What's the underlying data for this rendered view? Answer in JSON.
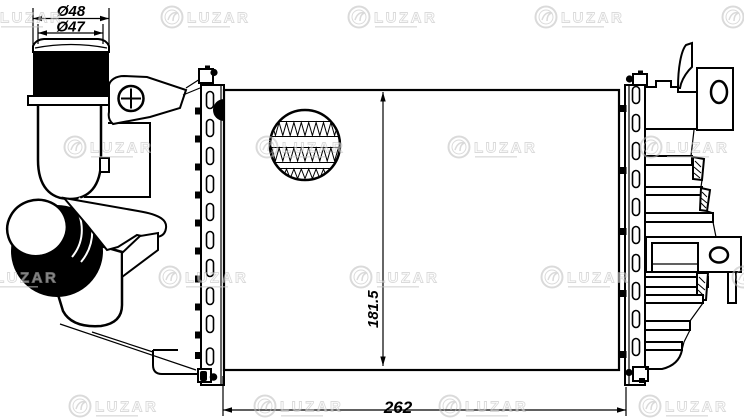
{
  "drawing": {
    "kind": "technical-part-drawing",
    "dimensions": {
      "pipe_outer_diameter": "Ø48",
      "pipe_inner_diameter": "Ø47",
      "core_height": "181.5",
      "core_width": "262"
    },
    "watermark": {
      "brand": "LUZAR",
      "color": "#c8c8c8"
    },
    "colors": {
      "line": "#000000",
      "background": "#ffffff"
    }
  }
}
